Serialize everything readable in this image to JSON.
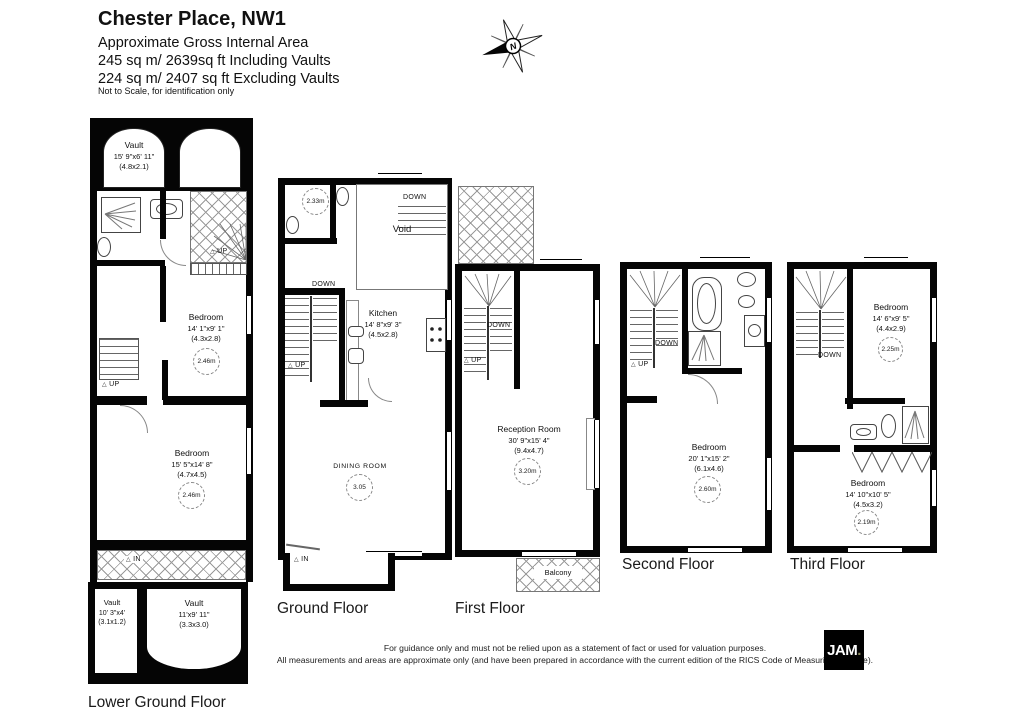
{
  "header": {
    "title": "Chester Place, NW1",
    "line1": "Approximate Gross Internal Area",
    "line2": "245 sq m/ 2639sq ft Including Vaults",
    "line3": "224 sq m/ 2407 sq ft Excluding Vaults",
    "note": "Not to Scale, for identification only",
    "compass_n": "N"
  },
  "floors": {
    "lower_ground": {
      "label": "Lower Ground Floor",
      "vault_top": {
        "name": "Vault",
        "imperial": "15' 9\"x6' 11\"",
        "metric": "(4.8x2.1)"
      },
      "terrace_up": "UP",
      "bedroom1": {
        "name": "Bedroom",
        "imperial": "14' 1\"x9' 1\"",
        "metric": "(4.3x2.8)",
        "height": "2.46m"
      },
      "stairs_up": "UP",
      "bedroom2": {
        "name": "Bedroom",
        "imperial": "15' 5\"x14' 8\"",
        "metric": "(4.7x4.5)",
        "height": "2.46m"
      },
      "in_label": "IN",
      "vault_left": {
        "name": "Vault",
        "imperial": "10' 3\"x4'",
        "metric": "(3.1x1.2)"
      },
      "vault_right": {
        "name": "Vault",
        "imperial": "11'x9' 11\"",
        "metric": "(3.3x3.0)"
      }
    },
    "ground": {
      "label": "Ground Floor",
      "wc_height": "2.33m",
      "void_label": "Void",
      "down_top": "DOWN",
      "stairs_down": "DOWN",
      "stairs_up": "UP",
      "kitchen": {
        "name": "Kitchen",
        "imperial": "14' 8\"x9' 3\"",
        "metric": "(4.5x2.8)"
      },
      "dining": {
        "name": "DINING ROOM",
        "height": "3.05"
      },
      "in_label": "IN"
    },
    "first": {
      "label": "First Floor",
      "stairs_down": "DOWN",
      "stairs_up": "UP",
      "reception": {
        "name": "Reception Room",
        "imperial": "30' 9\"x15' 4\"",
        "metric": "(9.4x4.7)",
        "height": "3.20m"
      },
      "balcony_label": "Balcony"
    },
    "second": {
      "label": "Second Floor",
      "stairs_down": "DOWN",
      "stairs_up": "UP",
      "bedroom": {
        "name": "Bedroom",
        "imperial": "20' 1\"x15' 2\"",
        "metric": "(6.1x4.6)",
        "height": "2.60m"
      }
    },
    "third": {
      "label": "Third Floor",
      "stairs_down": "DOWN",
      "bedroom1": {
        "name": "Bedroom",
        "imperial": "14' 6\"x9' 5\"",
        "metric": "(4.4x2.9)",
        "height": "2.25m"
      },
      "bedroom2": {
        "name": "Bedroom",
        "imperial": "14' 10\"x10' 5\"",
        "metric": "(4.5x3.2)",
        "height": "2.19m"
      }
    }
  },
  "footer": {
    "line1": "For guidance only and must not be relied upon as a statement of fact or used for valuation purposes.",
    "line2": "All measurements and areas are approximate only (and have been prepared in accordance with the current edition of the RICS Code of Measuring Practice).",
    "logo": "JAM",
    "logo_dot": "."
  }
}
